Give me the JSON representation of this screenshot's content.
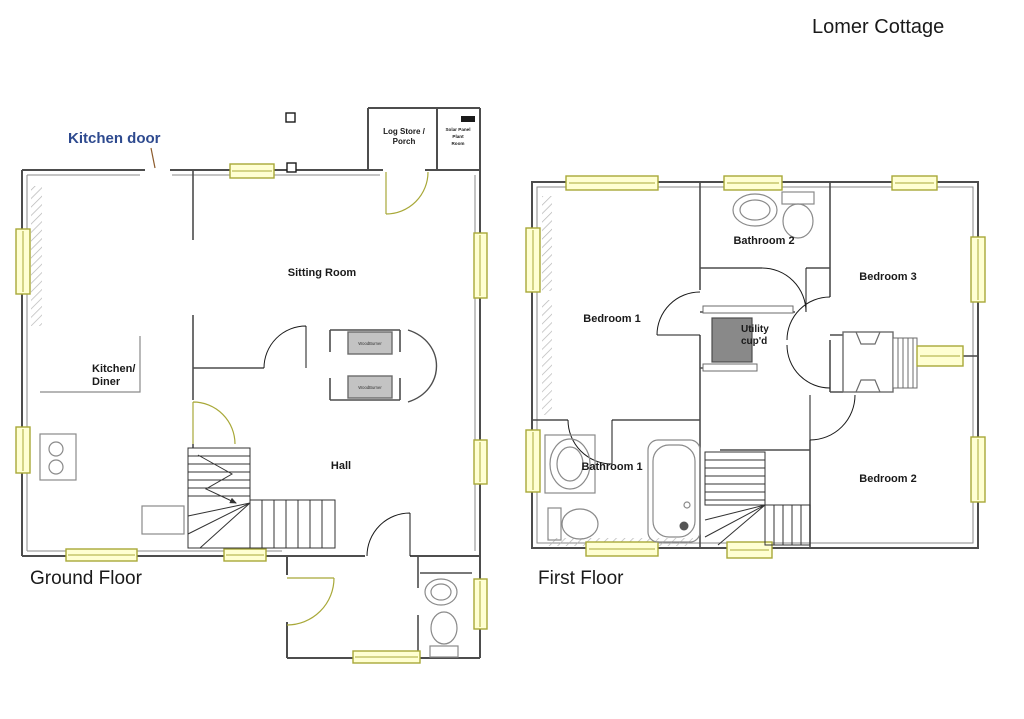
{
  "page": {
    "title": "Lomer Cottage"
  },
  "ground_floor": {
    "label": "Ground Floor",
    "kitchen_door_note": "Kitchen door",
    "rooms": {
      "sitting_room": "Sitting Room",
      "kitchen_line1": "Kitchen/",
      "kitchen_line2": "Diner",
      "hall": "Hall",
      "log_store_line1": "Log Store /",
      "log_store_line2": "Porch",
      "plant_line1": "Solar Panel",
      "plant_line2": "Plant",
      "plant_line3": "Room",
      "woodburner": "WoodBurner"
    }
  },
  "first_floor": {
    "label": "First Floor",
    "rooms": {
      "bedroom1": "Bedroom 1",
      "bedroom2": "Bedroom 2",
      "bedroom3": "Bedroom 3",
      "bathroom1": "Bathroom 1",
      "bathroom2": "Bathroom 2",
      "utility_line1": "Utility",
      "utility_line2": "cup'd"
    }
  },
  "colors": {
    "wall": "#4d4d4d",
    "window_border": "#a8a838",
    "window_fill": "#ffffd2",
    "annotation_blue": "#2e4a8f",
    "cupboard_gray": "#898989"
  }
}
